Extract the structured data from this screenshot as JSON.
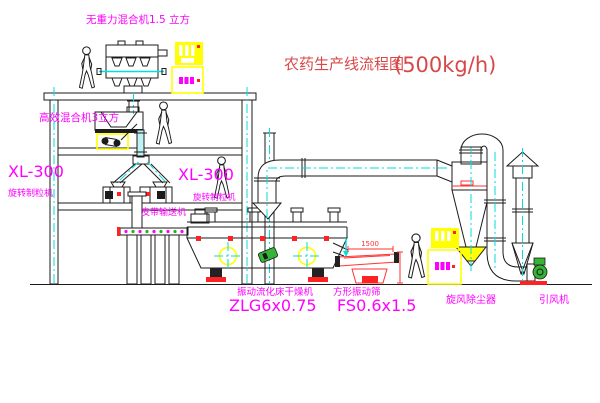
{
  "title": {
    "name": "农药生产线流程图",
    "capacity": "(500kg/h)"
  },
  "labels": {
    "gravity_free_mixer": "无重力混合机1.5 立方",
    "high_efficiency_mixer": "高效混合机3立方",
    "granulator_left_model": "XL-300",
    "granulator_left_name": "旋转制粒机",
    "granulator_right_model": "XL-300",
    "granulator_right_name": "旋转制粒机",
    "belt_conveyor": "皮带输送机",
    "fluid_bed_dryer_name": "振动流化床干燥机",
    "fluid_bed_dryer_model": "ZLG6x0.75",
    "vibrating_screen_name": "方形振动筛",
    "vibrating_screen_model": "FS0.6x1.5",
    "cyclone_collector": "旋风除尘器",
    "induced_draft_fan": "引风机"
  },
  "dimensions": {
    "screen_length": "1500"
  },
  "colors": {
    "label_magenta": "#ff00ff",
    "title_red": "#d84848",
    "centerline_cyan": "#00dede",
    "cabinet_yellow": "#ffff00",
    "accent_red": "#ff2222",
    "line_black": "#1b1b1b"
  }
}
